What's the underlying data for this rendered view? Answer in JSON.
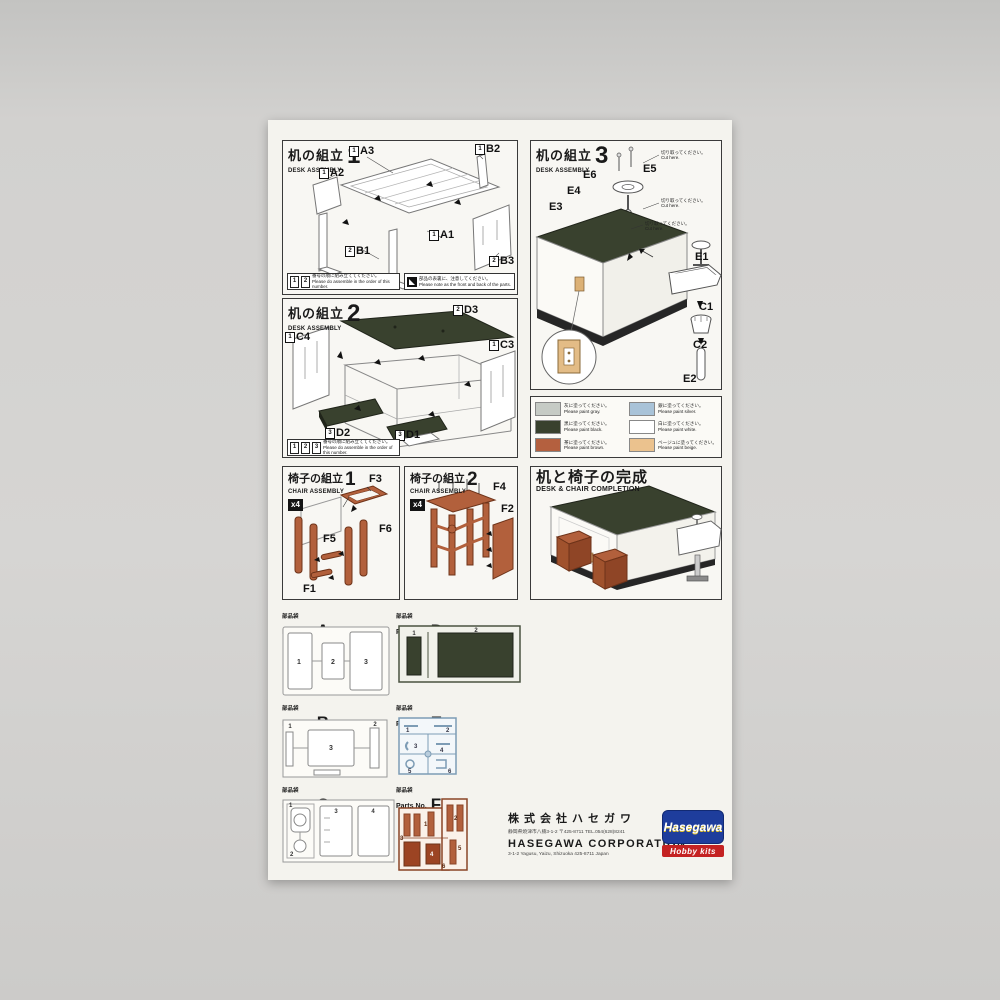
{
  "desk1": {
    "title_jp": "机の組立",
    "step": "1",
    "title_en": "DESK ASSEMBLY",
    "parts": [
      {
        "n": "1",
        "label": "A2"
      },
      {
        "n": "1",
        "label": "A3"
      },
      {
        "n": "1",
        "label": "B2"
      },
      {
        "n": "2",
        "label": "B1"
      },
      {
        "n": "1",
        "label": "A1"
      },
      {
        "n": "2",
        "label": "B3"
      }
    ],
    "note1": {
      "icons": [
        "1",
        "2"
      ],
      "jp": "番号の順に組み立ててください。",
      "en": "Please do assemble in the order of this number."
    },
    "note2": {
      "jp": "部品の表裏に、注意してください。",
      "en": "Please note as the front and back of the parts."
    }
  },
  "desk2": {
    "title_jp": "机の組立",
    "step": "2",
    "title_en": "DESK ASSEMBLY",
    "parts": [
      {
        "n": "1",
        "label": "C4"
      },
      {
        "n": "2",
        "label": "D3"
      },
      {
        "n": "1",
        "label": "C3"
      },
      {
        "n": "3",
        "label": "D2"
      },
      {
        "n": "3",
        "label": "D1"
      }
    ],
    "note1": {
      "icons": [
        "1",
        "2",
        "3"
      ],
      "jp": "番号の順に組み立ててください。",
      "en": "Please do assemble in the order of this number."
    }
  },
  "desk3": {
    "title_jp": "机の組立",
    "step": "3",
    "title_en": "DESK ASSEMBLY",
    "parts": [
      "E6",
      "E5",
      "E4",
      "E3",
      "E1",
      "C1",
      "C2",
      "E2"
    ],
    "cut_jp": "切り取ってください。",
    "cut_en": "Cut here."
  },
  "legend": {
    "items": [
      {
        "color": "#c6cbc5",
        "jp": "灰に塗ってください。",
        "en": "Please paint gray."
      },
      {
        "color": "#a9c3d8",
        "jp": "銀に塗ってください。",
        "en": "Please paint silver."
      },
      {
        "color": "#39412e",
        "jp": "黒に塗ってください。",
        "en": "Please paint black."
      },
      {
        "color": "#ffffff",
        "jp": "白に塗ってください。",
        "en": "Please paint white."
      },
      {
        "color": "#b4603f",
        "jp": "茶に塗ってください。",
        "en": "Please paint brown."
      },
      {
        "color": "#ebc28e",
        "jp": "ベージュに塗ってください。",
        "en": "Please paint beige."
      }
    ]
  },
  "chair1": {
    "title_jp": "椅子の組立",
    "step": "1",
    "title_en": "CHAIR ASSEMBLY",
    "qty": "x4",
    "parts": [
      "F3",
      "F5",
      "F6",
      "F1"
    ]
  },
  "chair2": {
    "title_jp": "椅子の組立",
    "step": "2",
    "title_en": "CHAIR ASSEMBLY",
    "qty": "x4",
    "parts": [
      "F4",
      "F2"
    ]
  },
  "completion": {
    "title_jp": "机と椅子の完成",
    "title_en": "DESK & CHAIR COMPLETION"
  },
  "bags": {
    "kanji": "部品袋",
    "label": "Parts No.",
    "items": [
      {
        "letter": "A",
        "numbers": [
          "1",
          "2",
          "3"
        ]
      },
      {
        "letter": "D",
        "numbers": [
          "1",
          "2"
        ]
      },
      {
        "letter": "B",
        "numbers": [
          "1",
          "3",
          "2"
        ]
      },
      {
        "letter": "E",
        "numbers": [
          "1",
          "2",
          "3",
          "4",
          "5",
          "6"
        ]
      },
      {
        "letter": "C",
        "numbers": [
          "1",
          "2",
          "3",
          "4"
        ]
      },
      {
        "letter": "Fx4",
        "numbers": [
          "1",
          "2",
          "3",
          "4",
          "5",
          "6"
        ]
      }
    ]
  },
  "footer": {
    "company_jp": "株式会社ハセガワ",
    "address_jp": "静岡県焼津市八楠3-1-2 〒425-8711 TEL.054(628)8241",
    "company_en": "HASEGAWA CORPORATION",
    "address_en": "3-1-2 Yagusu, Yaizu, Shizuoka 425-8711 Japan",
    "logo_text": "Hasegawa",
    "logo_sub": "Hobby kits"
  }
}
